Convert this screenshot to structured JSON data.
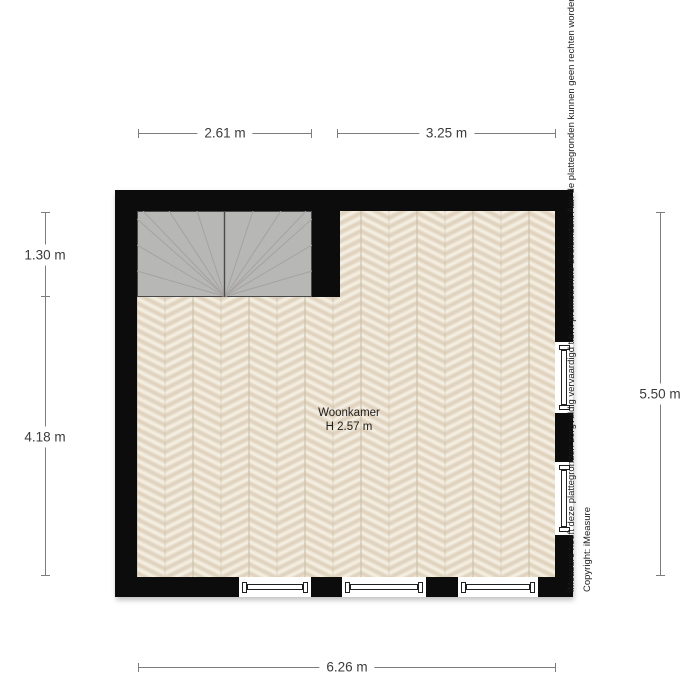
{
  "plan": {
    "room_label": "Woonkamer",
    "room_height": "H 2.57 m"
  },
  "dimensions": {
    "top_left": "2.61 m",
    "top_right": "3.25 m",
    "left_upper": "1.30 m",
    "left_lower": "4.18 m",
    "right": "5.50 m",
    "bottom": "6.26 m"
  },
  "footer": {
    "disclaimer": "iMeasure heeft deze plattegronden zorgvuldig vervaardigd t.b.v. promotionele doeleinden. Aan de plattegronden kunnen geen rechten worden",
    "copyright": "Copyright: iMeasure"
  },
  "colors": {
    "background": "#ffffff",
    "wall": "#0c0c0c",
    "stair_fill": "#b7b7b5",
    "stair_line": "#a5a3a0",
    "stair_border": "#4a4a4a",
    "floor_base": "#ebe2d1",
    "floor_accent": "#d8cab2",
    "floor_highlight": "#f6f1e6",
    "dim_line": "#7d7d7d",
    "dim_text": "#3b3b3b",
    "window_frame": "#1f1f1f",
    "disclaimer_text": "#1a1a1a",
    "room_text": "#1e1e1e"
  }
}
